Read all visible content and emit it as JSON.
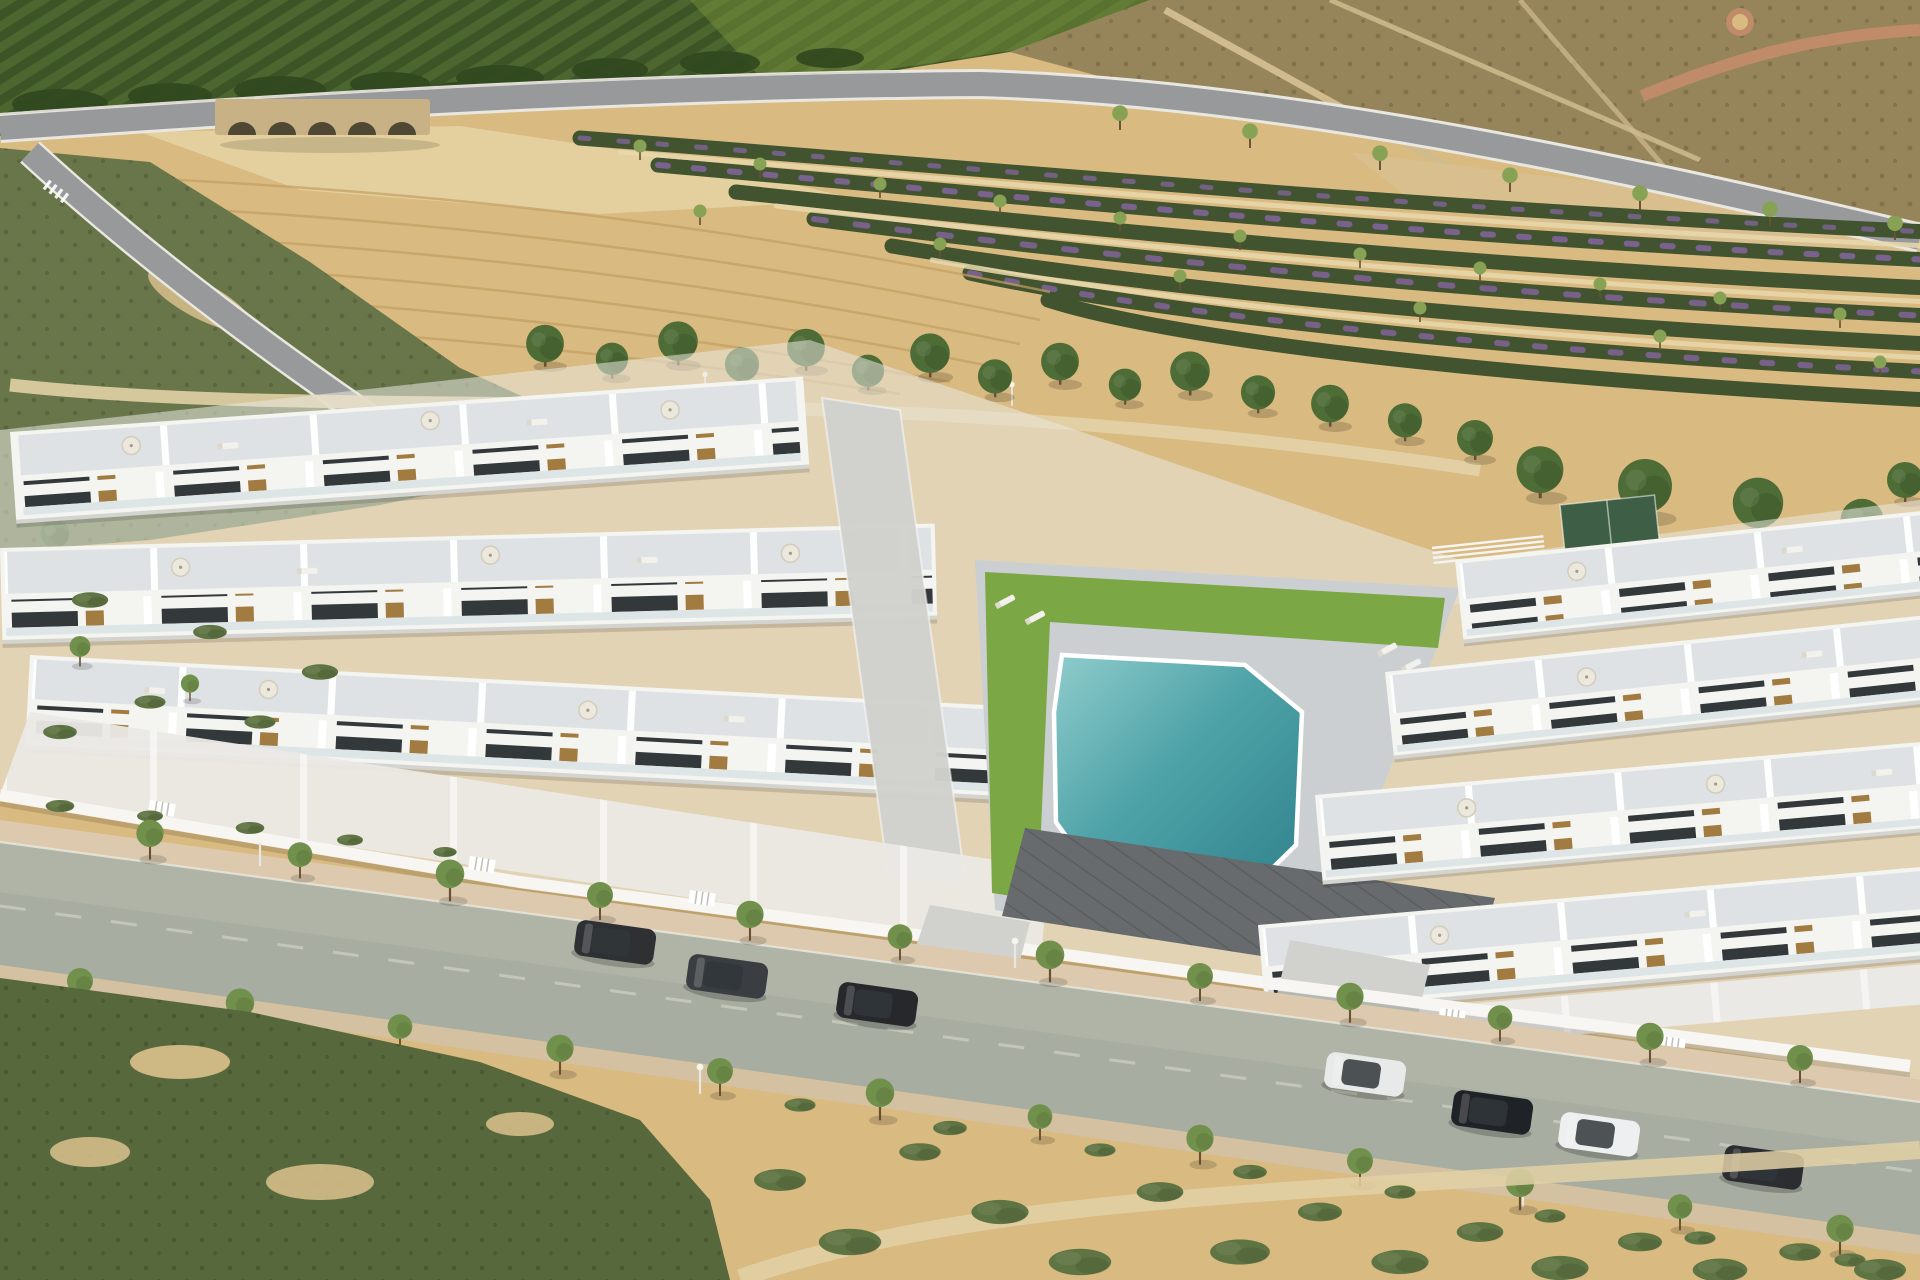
{
  "meta": {
    "type": "aerial-photograph",
    "description": "Aerial render of a modern white residential development of two-storey townhouses with rooftop solariums arranged around a communal pool courtyard, fronted by a tree-lined asphalt street with parked cars, and surrounded by a green orchard hillside, a stone bridge over a dry riverbed, a bare ochre field, diagonal rows of flowering shrubs, brown scrubland and sandy scrub with bushes in the foreground",
    "lighting": "bright daytime sun from upper left"
  },
  "palette": {
    "sand": "#d9ba80",
    "sand-light": "#e6d0a0",
    "field": "#d4ad6c",
    "plow": "#c3a062",
    "orchard": "#4c662f",
    "orchard-dark": "#3d5526",
    "orchard-light": "#7f973f",
    "scrub-brown": "#96855b",
    "scrub-brown-dark": "#73693f",
    "scrub-green": "#68764a",
    "scrub-dark": "#57693c",
    "bush-green": "#5f7443",
    "tree-green": "#70904b",
    "pine-green": "#4d6c36",
    "trunk": "#6b4f33",
    "flower-row-green": "#41532f",
    "flower-purple": "#84659f",
    "row-path": "#e8d8ad",
    "road": "#98999b",
    "road-edge": "#e9e7e0",
    "asphalt": "#a7ada1",
    "asphalt-light": "#b4b9ab",
    "sidewalk": "#ddcaae",
    "sidewalk2": "#d4c1a1",
    "path-sand": "#e2d1a6",
    "bridge-stone": "#c8b184",
    "arch-dark": "#4f4834",
    "riverbed": "#e4cf9e",
    "dirt-path": "#cfbb8e",
    "red-path": "#bf8b68",
    "bldg-white": "#f4f4f1",
    "bldg-shadow": "#c7ccd0",
    "roof-tile": "#dfe2e4",
    "deck": "#cbcfd2",
    "window": "#33383b",
    "wood": "#a17b40",
    "glass": "#d9e2e5",
    "court-dark": "#686b6d",
    "paving": "#d1d2ce",
    "grass": "#7ba745",
    "pool-deep": "#2f808b",
    "pool-light": "#90cccc",
    "wall-white": "#f7f6f2"
  },
  "scene": {
    "development": {
      "building_color": "white",
      "storeys": 2,
      "left_wing_rows": 3,
      "right_wing_rows": 4,
      "features": [
        "rooftop solariums with parasols and sun loungers",
        "glass balconies",
        "wood-slat facade accents",
        "grey tiled roof terraces",
        "white perimeter wall with slatted gates",
        "dark grey tiled roof over front-centre block"
      ]
    },
    "pool": {
      "shape": "irregular polygon",
      "water_color_deep": "#2f808b",
      "water_color_shallow": "#90cccc",
      "surround": "grey tile deck with lawn strips",
      "loungers": 4,
      "parasols": 1
    },
    "street": {
      "surface": "asphalt",
      "direction": "diagonal, lower-left to right",
      "sidewalks": 2,
      "street_trees_upper": 12,
      "street_trees_lower": 12,
      "lampposts": 4
    },
    "cars": [
      {
        "id": "car-1",
        "color": "#2e3034",
        "description": "dark hatchback parked on upper side"
      },
      {
        "id": "car-2",
        "color": "#3a3d41",
        "description": "dark SUV parked on upper side"
      },
      {
        "id": "car-3",
        "color": "#26282c",
        "description": "black car parked on upper side"
      },
      {
        "id": "car-4",
        "color": "#e8eaea",
        "description": "white hatchback parked on upper side"
      },
      {
        "id": "car-5",
        "color": "#1f2226",
        "description": "black hatchback parked on upper side"
      },
      {
        "id": "car-6",
        "color": "#edeff0",
        "description": "white crossover parked on upper side"
      },
      {
        "id": "car-7",
        "color": "#2b2d31",
        "description": "dark car parked near right edge"
      }
    ],
    "surroundings": [
      "green orchard rows on hillside (top left)",
      "stone bridge with five arches over a dry riverbed",
      "bare ochre ploughed field (centre)",
      "diagonal rows of flowering shrubs with purple blooms and saplings (top right)",
      "brown scrubland crossed by dirt tracks and a reddish path with a small roundabout (far top right)",
      "row of pine trees along a footpath behind the houses",
      "olive-green scrub with sandy patches in the foreground"
    ],
    "bridge_arches": 5,
    "pine_trees": 15
  }
}
